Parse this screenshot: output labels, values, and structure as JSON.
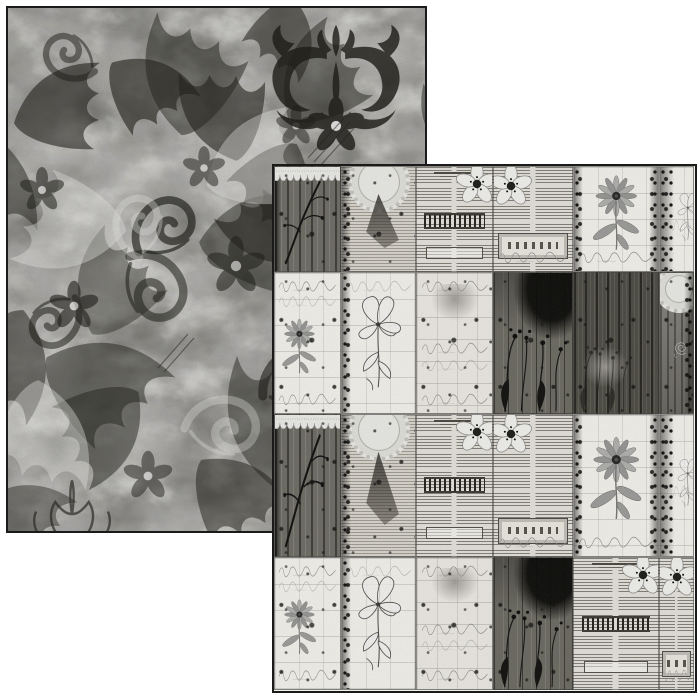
{
  "canvas": {
    "width": 700,
    "height": 700,
    "background": "#ffffff"
  },
  "product": {
    "description": "two overlapping sheets of black-and-white patterned scrapbook paper on a white background",
    "back_side_motif": "grunge floral damask with acanthus scrolls, leaves and five-petal flowers",
    "front_side_motif": "grid collage of vintage botanical ephemera cards: newsprint, pressed flowers, sketches, lace, script and dark wood textures"
  },
  "back_sheet": {
    "name": "damask-grunge-side",
    "left": 6,
    "top": 6,
    "width": 421,
    "height": 527,
    "border_color": "#1a1a1a"
  },
  "front_sheet": {
    "name": "ephemera-collage-side",
    "left": 272,
    "top": 164,
    "width": 425,
    "height": 529,
    "border_color": "#1a1a1a",
    "grid": {
      "rows": 4,
      "visible_columns": 6
    },
    "cards": [
      {
        "x": 0,
        "y": 0,
        "w": 67,
        "h": 106,
        "type": "wood-branch"
      },
      {
        "x": 67,
        "y": 0,
        "w": 75,
        "h": 106,
        "type": "lace-news"
      },
      {
        "x": 142,
        "y": 0,
        "w": 77,
        "h": 106,
        "type": "news-blossom"
      },
      {
        "x": 219,
        "y": 0,
        "w": 80,
        "h": 106,
        "type": "news-ticket"
      },
      {
        "x": 299,
        "y": 0,
        "w": 86,
        "h": 106,
        "type": "floral-daisy"
      },
      {
        "x": 385,
        "y": 0,
        "w": 35,
        "h": 106,
        "type": "floral-edge"
      },
      {
        "x": 0,
        "y": 106,
        "w": 67,
        "h": 142,
        "type": "script-daisy"
      },
      {
        "x": 67,
        "y": 106,
        "w": 75,
        "h": 142,
        "type": "sketch-lily"
      },
      {
        "x": 142,
        "y": 106,
        "w": 77,
        "h": 142,
        "type": "script-pale"
      },
      {
        "x": 219,
        "y": 106,
        "w": 80,
        "h": 142,
        "type": "wood-plants"
      },
      {
        "x": 299,
        "y": 106,
        "w": 86,
        "h": 142,
        "type": "wood-planks"
      },
      {
        "x": 385,
        "y": 106,
        "w": 35,
        "h": 142,
        "type": "lace-rose"
      },
      {
        "x": 0,
        "y": 248,
        "w": 67,
        "h": 143,
        "type": "wood-branch"
      },
      {
        "x": 67,
        "y": 248,
        "w": 75,
        "h": 143,
        "type": "lace-news"
      },
      {
        "x": 142,
        "y": 248,
        "w": 77,
        "h": 143,
        "type": "news-blossom"
      },
      {
        "x": 219,
        "y": 248,
        "w": 80,
        "h": 143,
        "type": "news-ticket"
      },
      {
        "x": 299,
        "y": 248,
        "w": 86,
        "h": 143,
        "type": "floral-daisy"
      },
      {
        "x": 385,
        "y": 248,
        "w": 35,
        "h": 143,
        "type": "floral-edge"
      },
      {
        "x": 0,
        "y": 391,
        "w": 67,
        "h": 133,
        "type": "script-daisy"
      },
      {
        "x": 67,
        "y": 391,
        "w": 75,
        "h": 133,
        "type": "sketch-lily"
      },
      {
        "x": 142,
        "y": 391,
        "w": 77,
        "h": 133,
        "type": "script-pale"
      },
      {
        "x": 219,
        "y": 391,
        "w": 80,
        "h": 133,
        "type": "wood-plants"
      },
      {
        "x": 299,
        "y": 391,
        "w": 86,
        "h": 133,
        "type": "news-blossom"
      },
      {
        "x": 385,
        "y": 391,
        "w": 35,
        "h": 133,
        "type": "news-ticket"
      }
    ]
  },
  "palette": {
    "paper_white": "#ffffff",
    "ink_dark": "#1a1a1a",
    "newsprint_bg": "#e6e4df",
    "card_white": "#f5f4f0",
    "pale_bg": "#edebe6",
    "wood_dark": "#4f4e48",
    "wood_mid": "#706f69",
    "damask_base": "#c7c6c4",
    "damask_dark": "#23221f",
    "mid_gray": "#8a8a8a"
  }
}
